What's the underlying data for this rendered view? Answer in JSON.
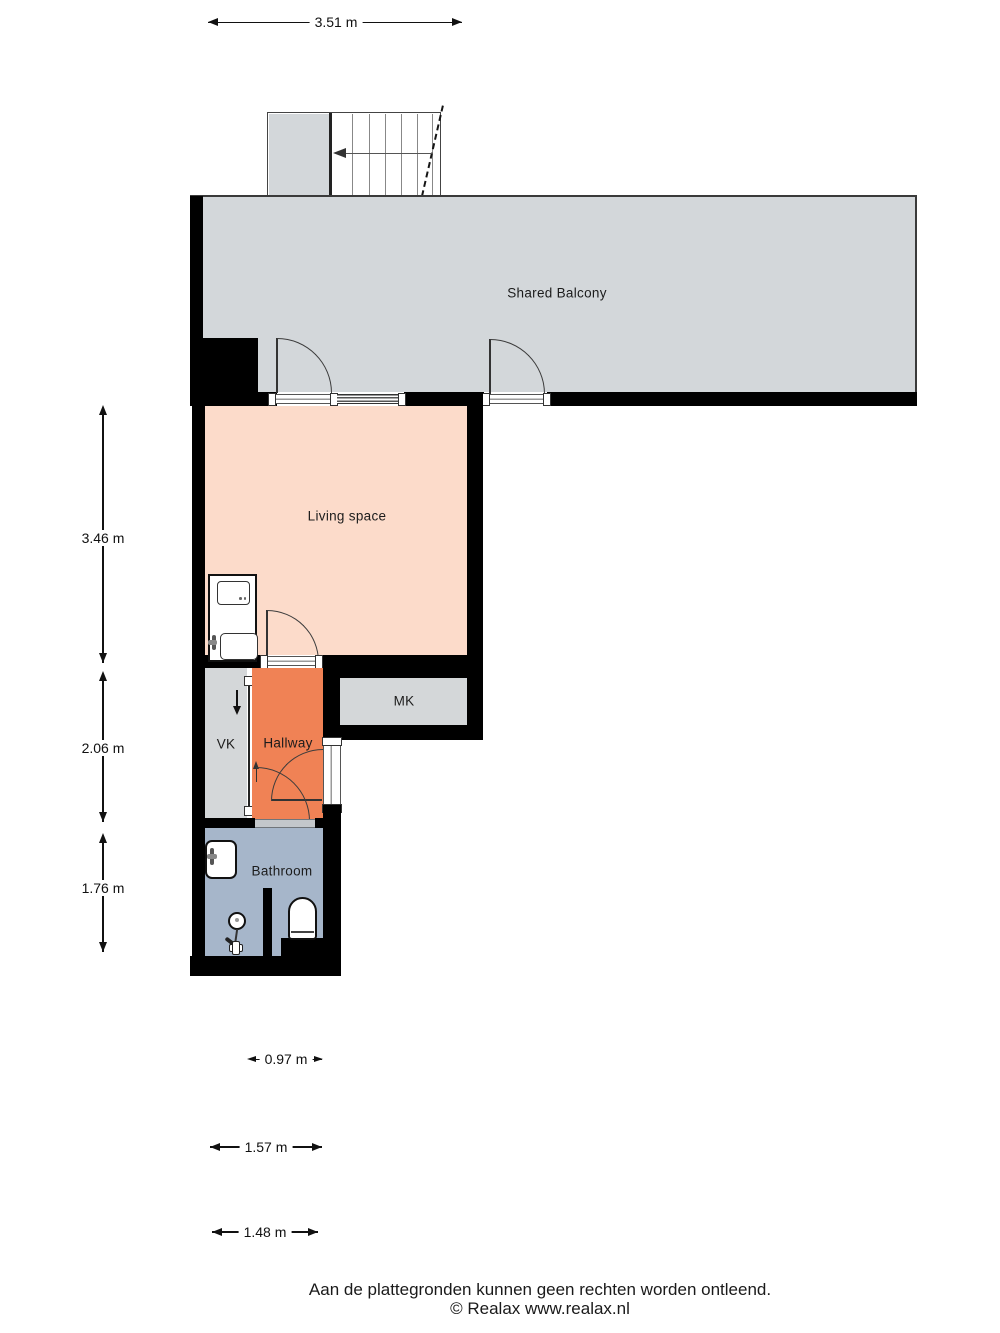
{
  "plan": {
    "rooms": [
      {
        "id": "shared-balcony",
        "label": "Shared Balcony"
      },
      {
        "id": "living-space",
        "label": "Living space"
      },
      {
        "id": "mk",
        "label": "MK"
      },
      {
        "id": "vk",
        "label": "VK"
      },
      {
        "id": "hallway",
        "label": "Hallway"
      },
      {
        "id": "bathroom",
        "label": "Bathroom"
      }
    ],
    "dimensions": {
      "top": "3.51 m",
      "left": [
        "3.46 m",
        "2.06 m",
        "1.76 m"
      ],
      "bottom": [
        "0.97 m",
        "1.57 m",
        "1.48 m"
      ]
    },
    "colors": {
      "balcony": "#d3d7da",
      "living": "#fcdbca",
      "hallway": "#f08255",
      "bathroom": "#a6b6ca",
      "closet": "#d4d7d9",
      "wall": "#000000"
    },
    "icons": {
      "stairs_direction": "arrow-left",
      "vk_shaft": "arrow-down"
    },
    "footer": {
      "disclaimer": "Aan de plattegronden kunnen geen rechten worden ontleend.",
      "copyright": "© Realax www.realax.nl"
    }
  }
}
